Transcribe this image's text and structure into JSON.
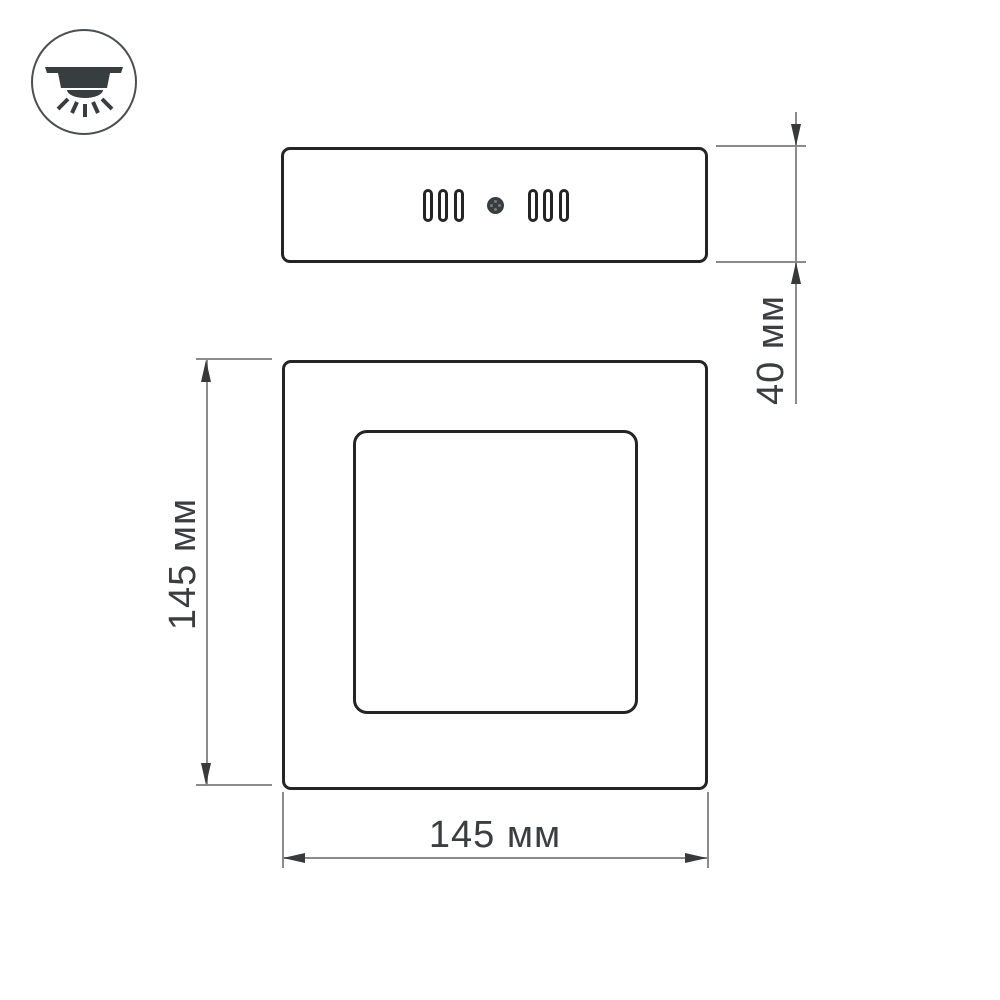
{
  "colors": {
    "outline": "#242424",
    "dim_line": "#8b8b8b",
    "arrow": "#38393a",
    "text": "#3b3e40",
    "icon": "#383d40",
    "icon_ring": "#4c4f52",
    "bg": "#ffffff"
  },
  "icon": {
    "name": "surface-mounted-ceiling-light"
  },
  "dimensions": {
    "panel_thickness": {
      "label": "40 мм"
    },
    "panel_height": {
      "label": "145 мм"
    },
    "panel_width": {
      "label": "145 мм"
    }
  }
}
